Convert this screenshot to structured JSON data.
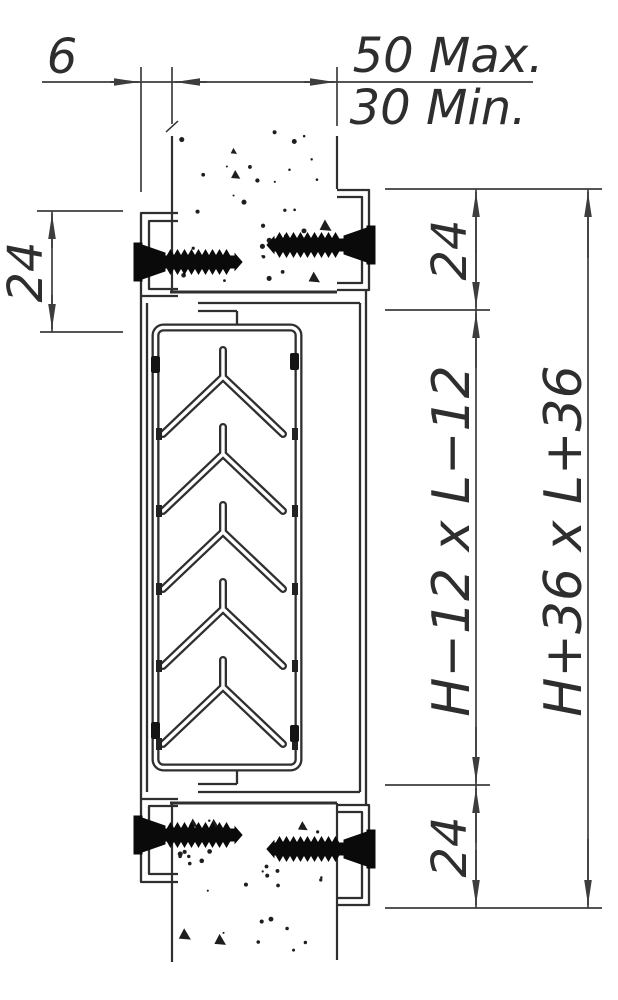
{
  "drawing_labels": {
    "gap": "6",
    "wall_max": "50 Max.",
    "wall_min": "30 Min.",
    "flange_overlap": "24",
    "frame_top_margin": "24",
    "core_dimension": "H−12 x L−12",
    "frame_bottom_margin": "24",
    "overall_dimension": "H+36 x L+36"
  },
  "colors": {
    "line": "#2f2f2f",
    "dimension": "#3d3d3d",
    "screw": "#0a0a0a",
    "background": "#ffffff"
  }
}
